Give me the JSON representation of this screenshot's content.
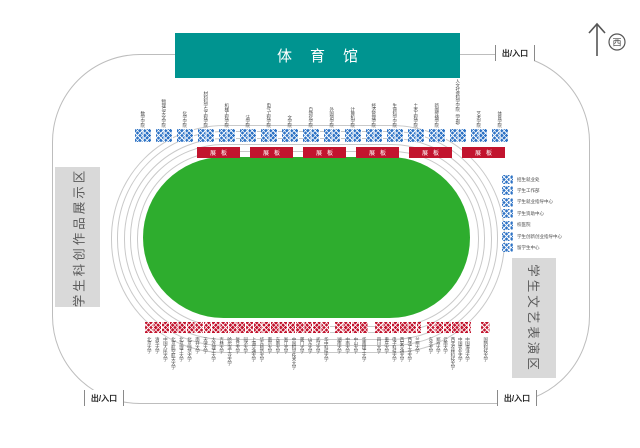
{
  "banner": {
    "title": "体育馆"
  },
  "compass": {
    "direction": "西"
  },
  "gates": {
    "top_right": "出/入口",
    "bottom_left": "出/入口",
    "bottom_right": "出/入口"
  },
  "zones": {
    "left": "学生科创作品展示区",
    "right": "学生文艺表演区"
  },
  "display_boards": {
    "label": "展板",
    "count": 6
  },
  "top_booths": {
    "labels": [
      "数学学院",
      "物理与天文学院",
      "化学学院",
      "材料科学与工程学院",
      "机械工程学院",
      "法学院",
      "电气工程学院",
      "文学院",
      "自动化学院",
      "外国语学院",
      "计算机学院",
      "经济管理学院",
      "生命科学学院",
      "土木工程学院",
      "新闻传播学院",
      "人文社会科学学院（学部）",
      "艺术学院",
      "体育学院"
    ]
  },
  "right_booths": {
    "labels": [
      "招生就业处",
      "学生工作部",
      "学生就业指导中心",
      "学生资助中心",
      "校医院",
      "学生创新创业指导中心",
      "留学生中心"
    ]
  },
  "bottom_booths": {
    "groups": [
      [
        "北京大学",
        "清华大学",
        "中国人民大学",
        "北京航空航天大学",
        "北京理工大学",
        "北京师范大学",
        "南开大学",
        "天津大学",
        "大连理工大学",
        "吉林大学",
        "哈尔滨工业大学",
        "复旦大学",
        "同济大学",
        "上海交通大学",
        "华东师范大学",
        "南京大学",
        "东南大学",
        "浙江大学",
        "中国科学技术大学",
        "厦门大学",
        "山东大学",
        "武汉大学",
        "华中科技大学"
      ],
      [
        "湖南大学",
        "中南大学",
        "中山大学",
        "华南理工大学"
      ],
      [
        "四川大学",
        "重庆大学",
        "电子科技大学",
        "西安交通大学",
        "西北工业大学",
        "兰州大学"
      ],
      [
        "东北大学",
        "郑州大学",
        "云南大学",
        "西北农林科技大学",
        "中国农业大学",
        "中国海洋大学"
      ],
      [
        "国防科技大学"
      ]
    ]
  },
  "colors": {
    "banner_teal": "#009490",
    "field_green": "#2ead2e",
    "booth_blue": "#2e73c5",
    "booth_red": "#c2142e",
    "zone_gray": "#d9d9d9"
  }
}
